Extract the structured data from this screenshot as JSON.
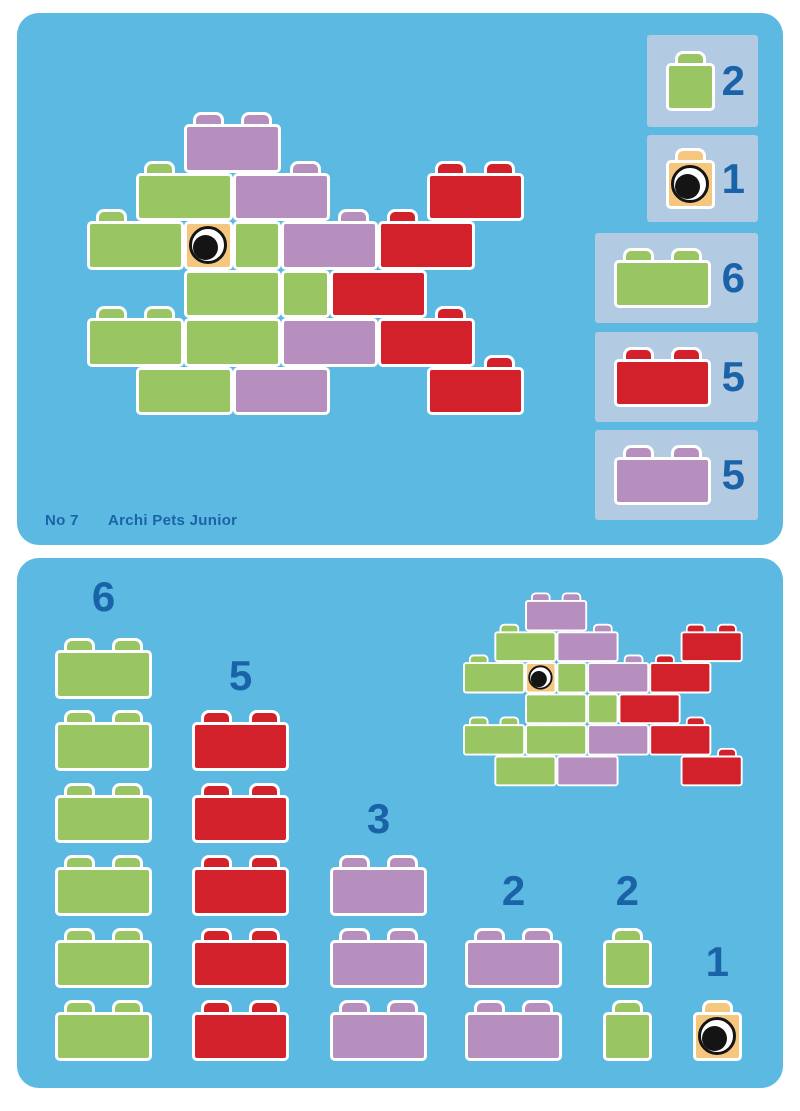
{
  "card": {
    "number": "No 7",
    "title": "Archi Pets Junior",
    "model_name": "fish"
  },
  "colors": {
    "page_background": "#FFFFFF",
    "panel": "#5CB9E1",
    "legend_box": "#B2CBE2",
    "ink_blue": "#1A63A8",
    "brick_outline": "#FFFFFF",
    "green": "#9AC563",
    "red": "#D2212B",
    "purple": "#B78FBF",
    "eye": "#F5C77E",
    "eye_black": "#141414"
  },
  "legend": [
    {
      "count": "2",
      "color": "green",
      "cells": 1
    },
    {
      "count": "1",
      "color": "eye",
      "cells": 1
    },
    {
      "count": "6",
      "color": "green",
      "cells": 2
    },
    {
      "count": "5",
      "color": "red",
      "cells": 2
    },
    {
      "count": "5",
      "color": "purple",
      "cells": 2
    }
  ],
  "parts": [
    {
      "count": "6",
      "color": "green",
      "cells": 2,
      "n": 6
    },
    {
      "count": "5",
      "color": "red",
      "cells": 2,
      "n": 5
    },
    {
      "count": "3",
      "color": "purple",
      "cells": 2,
      "n": 3
    },
    {
      "count": "2",
      "color": "purple",
      "cells": 2,
      "n": 2
    },
    {
      "count": "2",
      "color": "green",
      "cells": 1,
      "n": 2
    },
    {
      "count": "1",
      "color": "eye",
      "cells": 1,
      "n": 1
    }
  ],
  "model": {
    "bricks": [
      {
        "r": 0,
        "c": 2,
        "w": 2,
        "color": "purple"
      },
      {
        "r": 1,
        "c": 1,
        "w": 2,
        "color": "green"
      },
      {
        "r": 1,
        "c": 3,
        "w": 2,
        "color": "purple"
      },
      {
        "r": 1,
        "c": 7,
        "w": 2,
        "color": "red"
      },
      {
        "r": 2,
        "c": 0,
        "w": 2,
        "color": "green"
      },
      {
        "r": 2,
        "c": 2,
        "w": 1,
        "color": "eye"
      },
      {
        "r": 2,
        "c": 3,
        "w": 1,
        "color": "green"
      },
      {
        "r": 2,
        "c": 4,
        "w": 2,
        "color": "purple"
      },
      {
        "r": 2,
        "c": 6,
        "w": 2,
        "color": "red"
      },
      {
        "r": 3,
        "c": 2,
        "w": 2,
        "color": "green"
      },
      {
        "r": 3,
        "c": 4,
        "w": 1,
        "color": "green"
      },
      {
        "r": 3,
        "c": 5,
        "w": 2,
        "color": "red"
      },
      {
        "r": 4,
        "c": 0,
        "w": 2,
        "color": "green"
      },
      {
        "r": 4,
        "c": 2,
        "w": 2,
        "color": "green"
      },
      {
        "r": 4,
        "c": 4,
        "w": 2,
        "color": "purple"
      },
      {
        "r": 4,
        "c": 6,
        "w": 2,
        "color": "red"
      },
      {
        "r": 5,
        "c": 1,
        "w": 2,
        "color": "green"
      },
      {
        "r": 5,
        "c": 3,
        "w": 2,
        "color": "purple"
      },
      {
        "r": 5,
        "c": 7,
        "w": 2,
        "color": "red"
      }
    ]
  }
}
